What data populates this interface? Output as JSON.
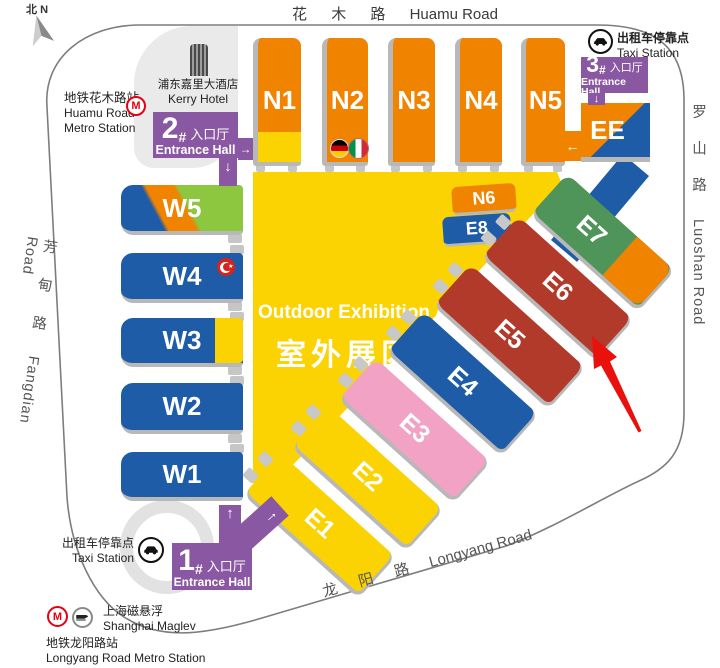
{
  "title": "Exhibition Center Site Map",
  "compass": {
    "cn": "北",
    "en": "N"
  },
  "roads": {
    "top_cn": "花 木 路",
    "top_en": "Huamu Road",
    "right_cn": "罗 山 路",
    "right_en": "Luoshan Road",
    "left_cn": "芳 甸 路",
    "left_en": "Fangdian Road",
    "bottom_cn": "龙 阳 路",
    "bottom_en": "Longyang Road"
  },
  "landmarks": {
    "huamu_metro": {
      "cn": "地铁花木路站",
      "en1": "Huamu Road",
      "en2": "Metro Station"
    },
    "kerry_hotel": {
      "cn": "浦东嘉里大酒店",
      "en": "Kerry Hotel"
    },
    "taxi_ne": {
      "cn": "出租车停靠点",
      "en": "Taxi Station"
    },
    "taxi_sw": {
      "cn": "出租车停靠点",
      "en": "Taxi Station"
    },
    "maglev": {
      "cn": "上海磁悬浮",
      "en": "Shanghai Maglev"
    },
    "longyang_metro": {
      "cn": "地铁龙阳路站",
      "en": "Longyang Road Metro Station"
    }
  },
  "entrances": {
    "e1": {
      "num": "1",
      "hash": "#",
      "cn": "入口厅",
      "en": "Entrance Hall"
    },
    "e2": {
      "num": "2",
      "hash": "#",
      "cn": "入口厅",
      "en": "Entrance Hall"
    },
    "e3": {
      "num": "3",
      "hash": "#",
      "cn": "入口厅",
      "en": "Entrance Hall"
    }
  },
  "halls": {
    "n1": "N1",
    "n2": "N2",
    "n3": "N3",
    "n4": "N4",
    "n5": "N5",
    "n6": "N6",
    "w1": "W1",
    "w2": "W2",
    "w3": "W3",
    "w4": "W4",
    "w5": "W5",
    "e1": "E1",
    "e2": "E2",
    "e3": "E3",
    "e4": "E4",
    "e5": "E5",
    "e6": "E6",
    "e7": "E7",
    "e8": "E8",
    "ee": "EE"
  },
  "outdoor": {
    "en": "Outdoor Exhibition Area",
    "cn": "室外展区"
  },
  "flags": [
    "germany",
    "italy",
    "turkey"
  ],
  "colors": {
    "hall_orange": "#F08300",
    "hall_yellow": "#FBD303",
    "hall_blue": "#1E5CA8",
    "hall_dark_red": "#B23A2B",
    "hall_pink": "#F2A2C4",
    "hall_green": "#4F9459",
    "hall_light_green": "#8DC63F",
    "entrance_purple": "#8A57A2",
    "shadow_gray": "#B8B8B8",
    "road_gray": "#7D7D7D",
    "area_gray": "#EAEAEA",
    "metro_red": "#E60012",
    "pointer_red": "#E8110C"
  }
}
